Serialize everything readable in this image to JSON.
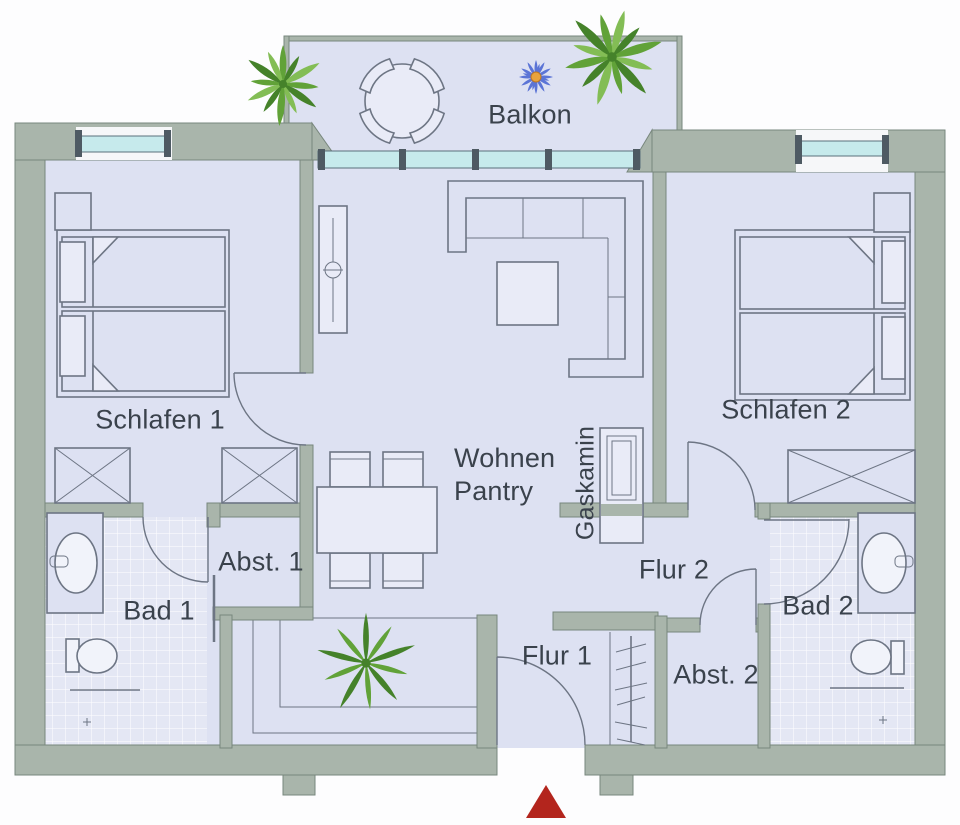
{
  "rooms": {
    "balkon": {
      "label": "Balkon"
    },
    "schlafen1": {
      "label": "Schlafen 1"
    },
    "schlafen2": {
      "label": "Schlafen 2"
    },
    "wohnen": {
      "line1": "Wohnen",
      "line2": "Pantry"
    },
    "gaskamin": {
      "label": "Gaskamin"
    },
    "flur1": {
      "label": "Flur 1"
    },
    "flur2": {
      "label": "Flur 2"
    },
    "abst1": {
      "label": "Abst. 1"
    },
    "abst2": {
      "label": "Abst. 2"
    },
    "bad1": {
      "label": "Bad 1"
    },
    "bad2": {
      "label": "Bad 2"
    }
  },
  "icons": {
    "entrance_arrow": "entrance-arrow-icon",
    "flower": "flower-icon",
    "plants": "plant-icon"
  },
  "colors": {
    "wall": "#a9b5ab",
    "wall_line": "#78877d",
    "floor": "#dde1f2",
    "floor_light": "#e9ebf7",
    "tile": "#e4e7f4",
    "tile_line": "#ffffff",
    "glass": "#c6eaec",
    "frame": "#59707b",
    "post": "#4e5a63",
    "line": "#6d7584",
    "text": "#3a424c",
    "arrow": "#b3251d",
    "petal": "#5b74d6",
    "flower_center": "#e8a33d",
    "plant_dark": "#45822a",
    "plant_mid": "#61a238",
    "plant_light": "#83bd55",
    "window_gap": "#f6f7f9"
  }
}
